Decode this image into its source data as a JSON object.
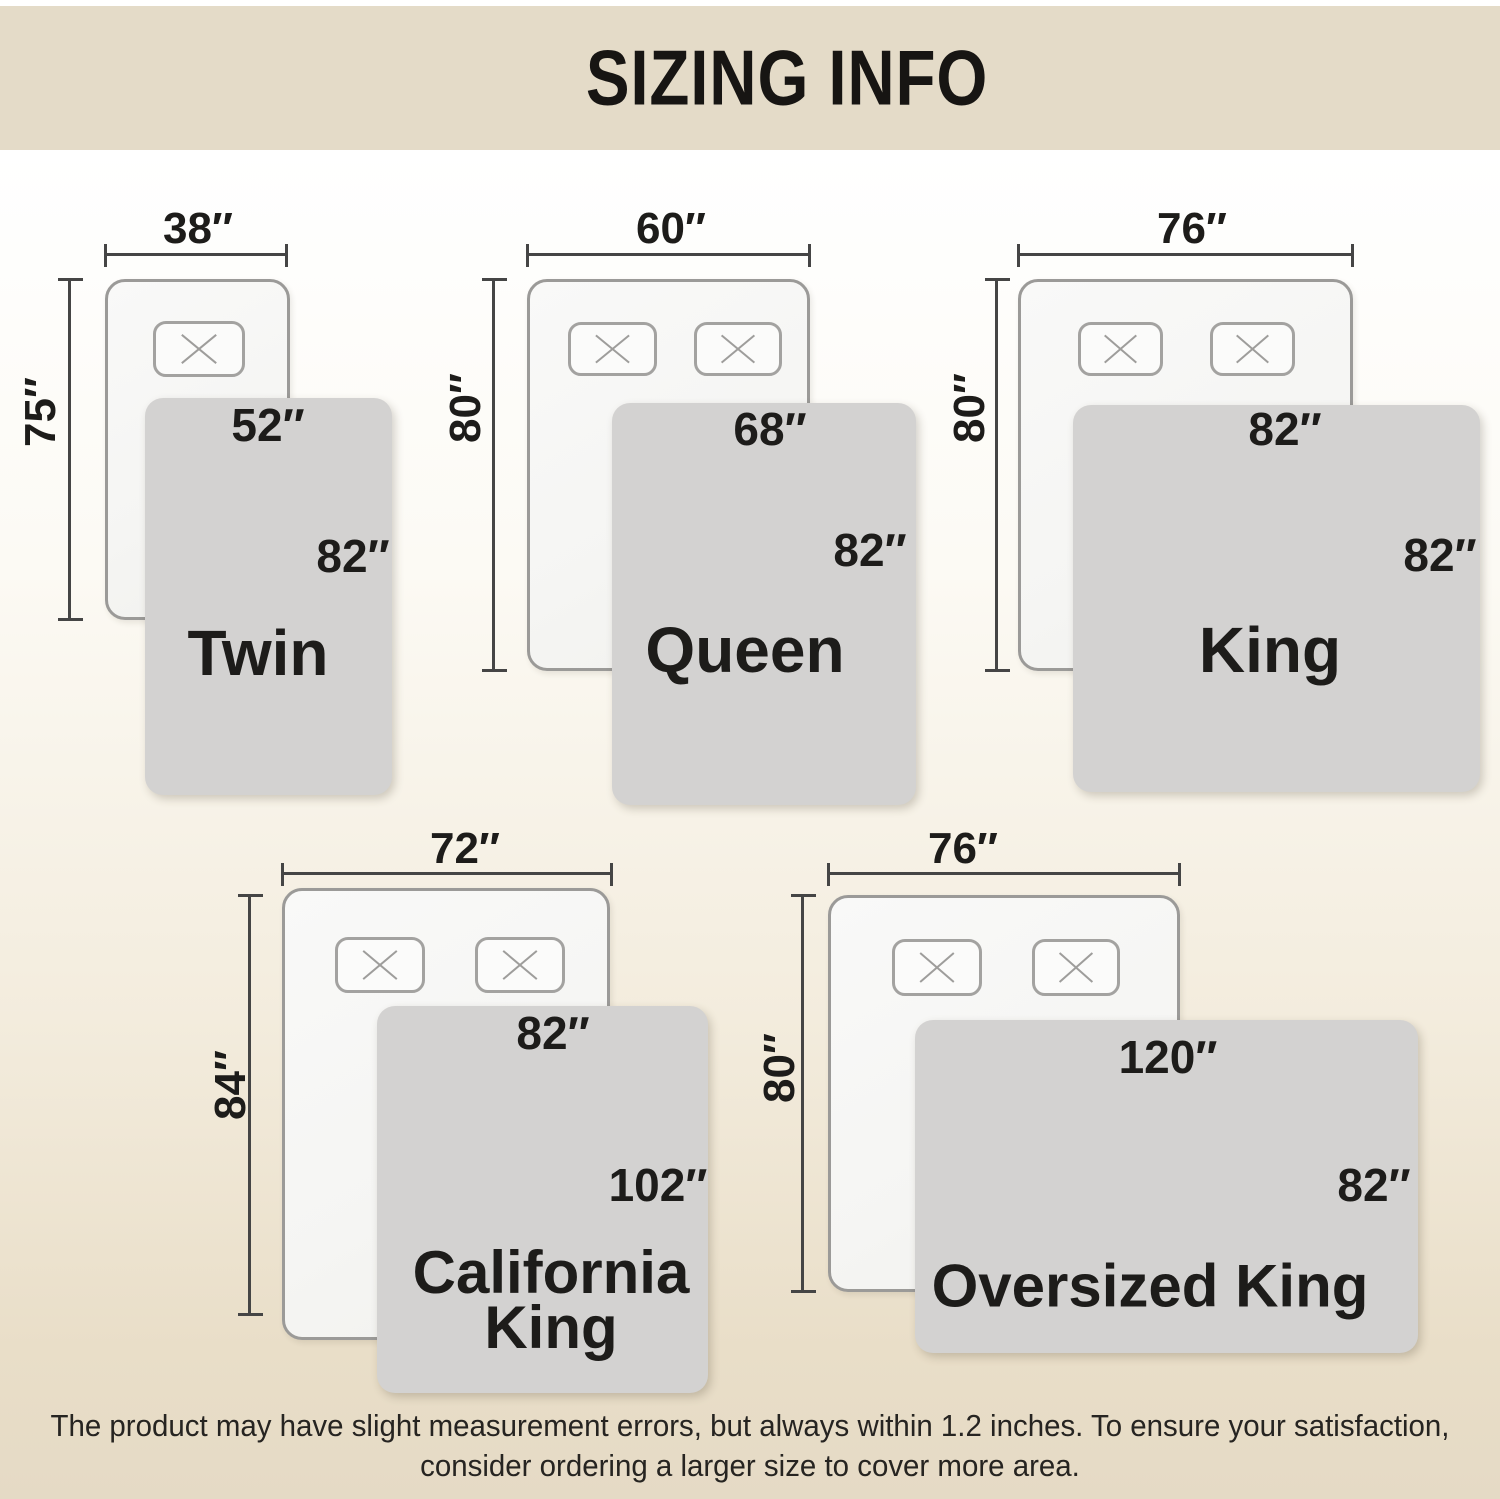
{
  "header": {
    "title": "SIZING INFO"
  },
  "sizes": [
    {
      "name": "Twin",
      "mattress_width": "38″",
      "mattress_length": "75″",
      "blanket_width": "52″",
      "blanket_length": "82″",
      "pillow_count": 1
    },
    {
      "name": "Queen",
      "mattress_width": "60″",
      "mattress_length": "80″",
      "blanket_width": "68″",
      "blanket_length": "82″",
      "pillow_count": 2
    },
    {
      "name": "King",
      "mattress_width": "76″",
      "mattress_length": "80″",
      "blanket_width": "82″",
      "blanket_length": "82″",
      "pillow_count": 2
    },
    {
      "name": "California King",
      "mattress_width": "72″",
      "mattress_length": "84″",
      "blanket_width": "82″",
      "blanket_length": "102″",
      "pillow_count": 2
    },
    {
      "name": "Oversized King",
      "mattress_width": "76″",
      "mattress_length": "80″",
      "blanket_width": "120″",
      "blanket_length": "82″",
      "pillow_count": 2
    }
  ],
  "footer": {
    "note": "The product may have slight measurement errors, but always within 1.2 inches. To ensure your satisfaction, consider ordering a larger size to cover more area."
  },
  "palette": {
    "header_bg": "#e4dbc8",
    "page_bottom_bg": "#e5dac5",
    "blanket_fill": "#d3d2d1",
    "bed_fill": "#f6f6f4",
    "bed_border": "#9b9a98",
    "dimension_line": "#454545",
    "text": "#1d1c1a"
  }
}
